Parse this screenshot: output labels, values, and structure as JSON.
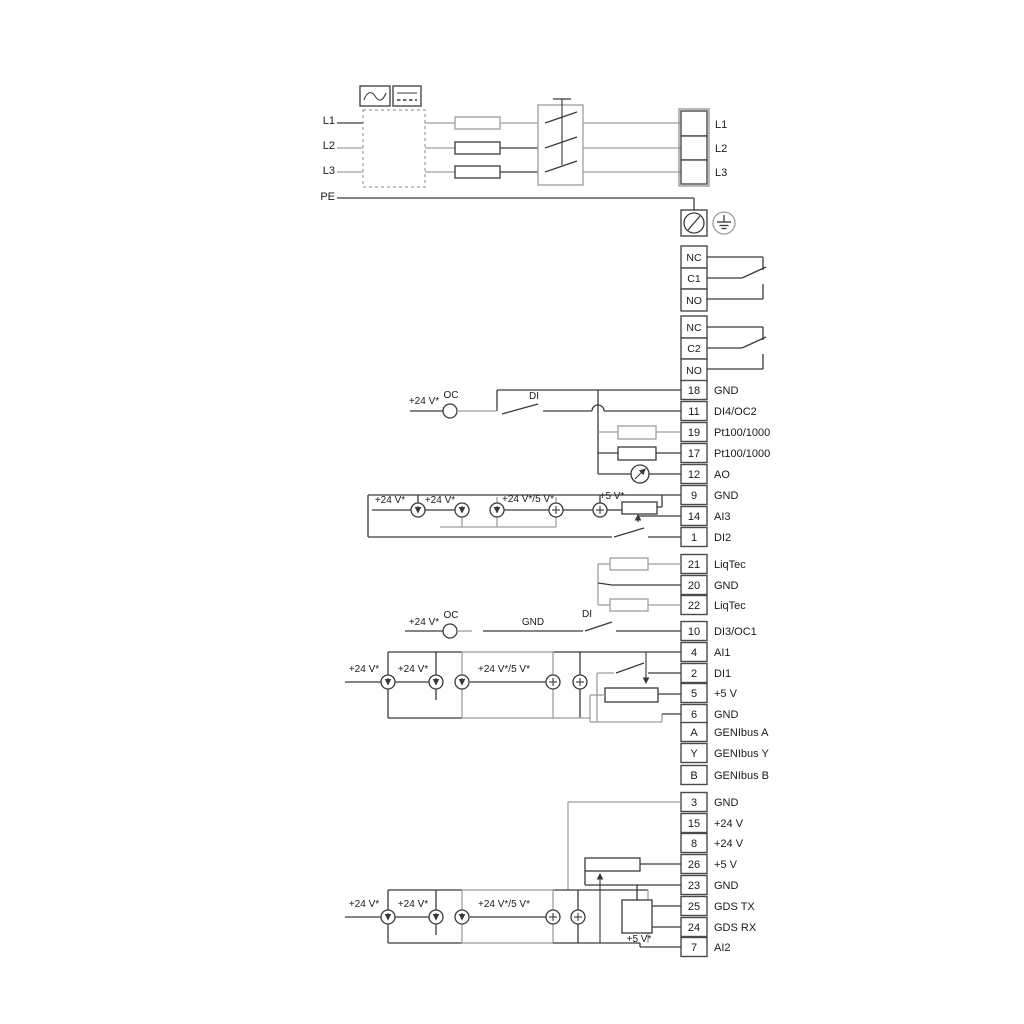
{
  "colors": {
    "line": "#3a3a3a",
    "line_alt": "#9e9e9e",
    "background": "#ffffff"
  },
  "power": {
    "inputs": [
      "L1",
      "L2",
      "L3",
      "PE"
    ],
    "output_terminals": [
      "L1",
      "L2",
      "L3"
    ]
  },
  "relay1": {
    "terminals": [
      "NC",
      "C1",
      "NO"
    ]
  },
  "relay2": {
    "terminals": [
      "NC",
      "C2",
      "NO"
    ]
  },
  "groupA": [
    {
      "no": "18",
      "label": "GND"
    },
    {
      "no": "11",
      "label": "DI4/OC2"
    },
    {
      "no": "19",
      "label": "Pt100/1000"
    },
    {
      "no": "17",
      "label": "Pt100/1000"
    },
    {
      "no": "12",
      "label": "AO"
    },
    {
      "no": "9",
      "label": "GND"
    },
    {
      "no": "14",
      "label": "AI3"
    },
    {
      "no": "1",
      "label": "DI2"
    }
  ],
  "groupB": [
    {
      "no": "21",
      "label": "LiqTec"
    },
    {
      "no": "20",
      "label": "GND"
    },
    {
      "no": "22",
      "label": "LiqTec"
    }
  ],
  "groupC": [
    {
      "no": "10",
      "label": "DI3/OC1"
    }
  ],
  "groupD": [
    {
      "no": "4",
      "label": "AI1"
    },
    {
      "no": "2",
      "label": "DI1"
    },
    {
      "no": "5",
      "label": "+5 V"
    },
    {
      "no": "6",
      "label": "GND"
    }
  ],
  "groupE": [
    {
      "no": "A",
      "label": "GENIbus A"
    },
    {
      "no": "Y",
      "label": "GENIbus Y"
    },
    {
      "no": "B",
      "label": "GENIbus B"
    }
  ],
  "groupF": [
    {
      "no": "3",
      "label": "GND"
    },
    {
      "no": "15",
      "label": "+24 V"
    },
    {
      "no": "8",
      "label": "+24 V"
    },
    {
      "no": "26",
      "label": "+5 V"
    },
    {
      "no": "23",
      "label": "GND"
    },
    {
      "no": "25",
      "label": "GDS TX"
    },
    {
      "no": "24",
      "label": "GDS RX"
    },
    {
      "no": "7",
      "label": "AI2"
    }
  ],
  "annotations": {
    "plus24": "+24 V*",
    "plus24or5": "+24 V*/5 V*",
    "plus5": "+5 V*",
    "oc": "OC",
    "di": "DI",
    "gnd": "GND"
  }
}
